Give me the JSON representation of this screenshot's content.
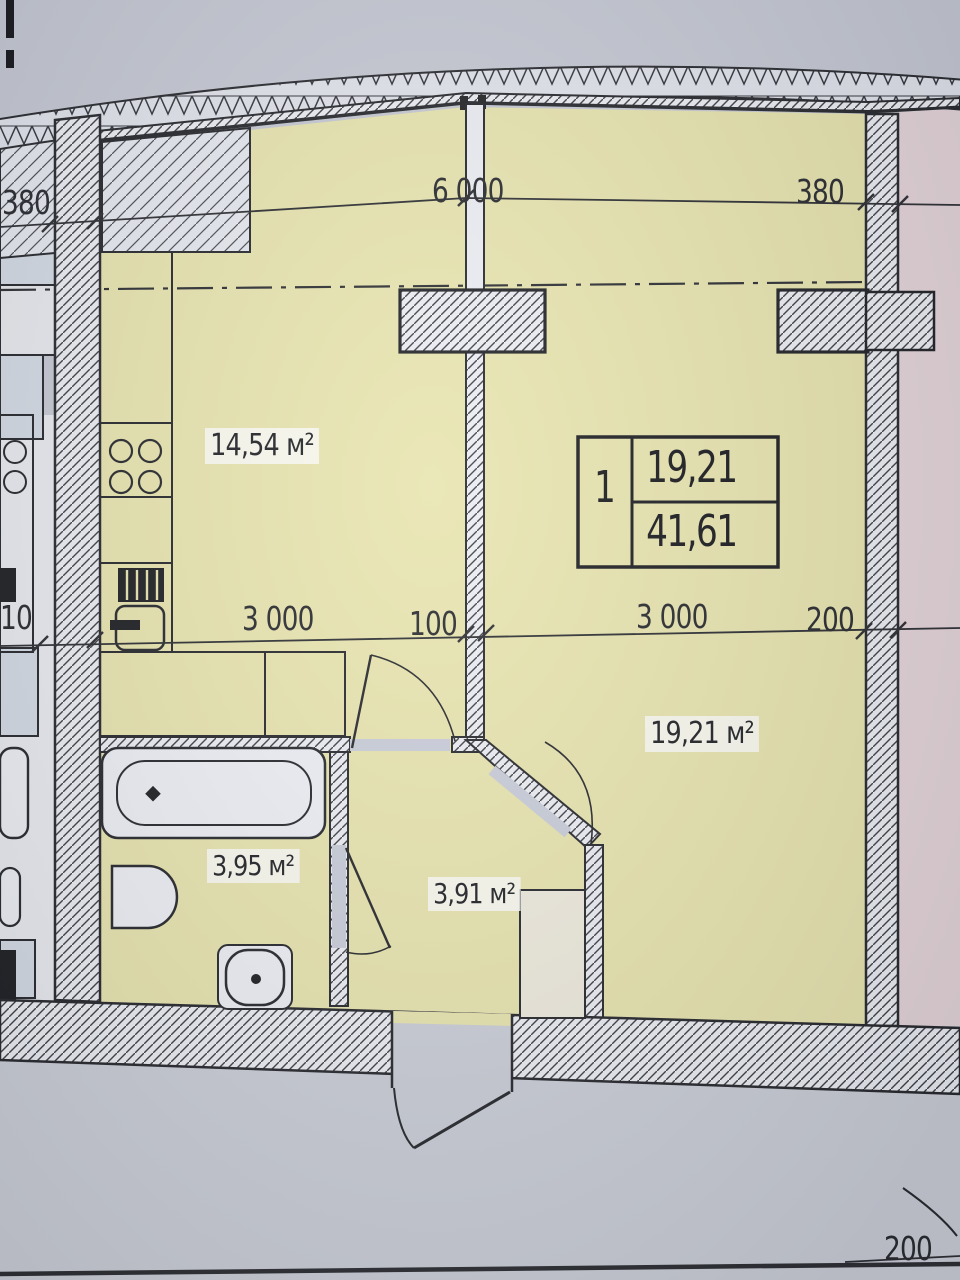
{
  "plan": {
    "stamp": {
      "flat_rooms": "1",
      "living_area": "19,21",
      "total_area": "41,61"
    },
    "rooms": {
      "kitchen": {
        "area": "14,54 м²"
      },
      "living_room": {
        "area": "19,21 м²"
      },
      "bathroom": {
        "area": "3,95 м²"
      },
      "hallway": {
        "area": "3,91 м²"
      }
    },
    "dimensions": {
      "top_left": "380",
      "top_center": "6 000",
      "top_right": "380",
      "mid_left_partial": "10",
      "mid_kitchen": "3 000",
      "mid_partition": "100",
      "mid_room": "3 000",
      "mid_wall": "200",
      "bottom_right": "200"
    },
    "colors": {
      "floor_yellow": "#e8e4ae",
      "neighbor_pink": "#e5d5d8",
      "neighbor_blue": "#d4dbe4",
      "page_gray": "#c6c9d3",
      "corridor_gray": "#cbced6",
      "door_gray": "#c9cdd9",
      "line_dark": "#24262a"
    }
  }
}
